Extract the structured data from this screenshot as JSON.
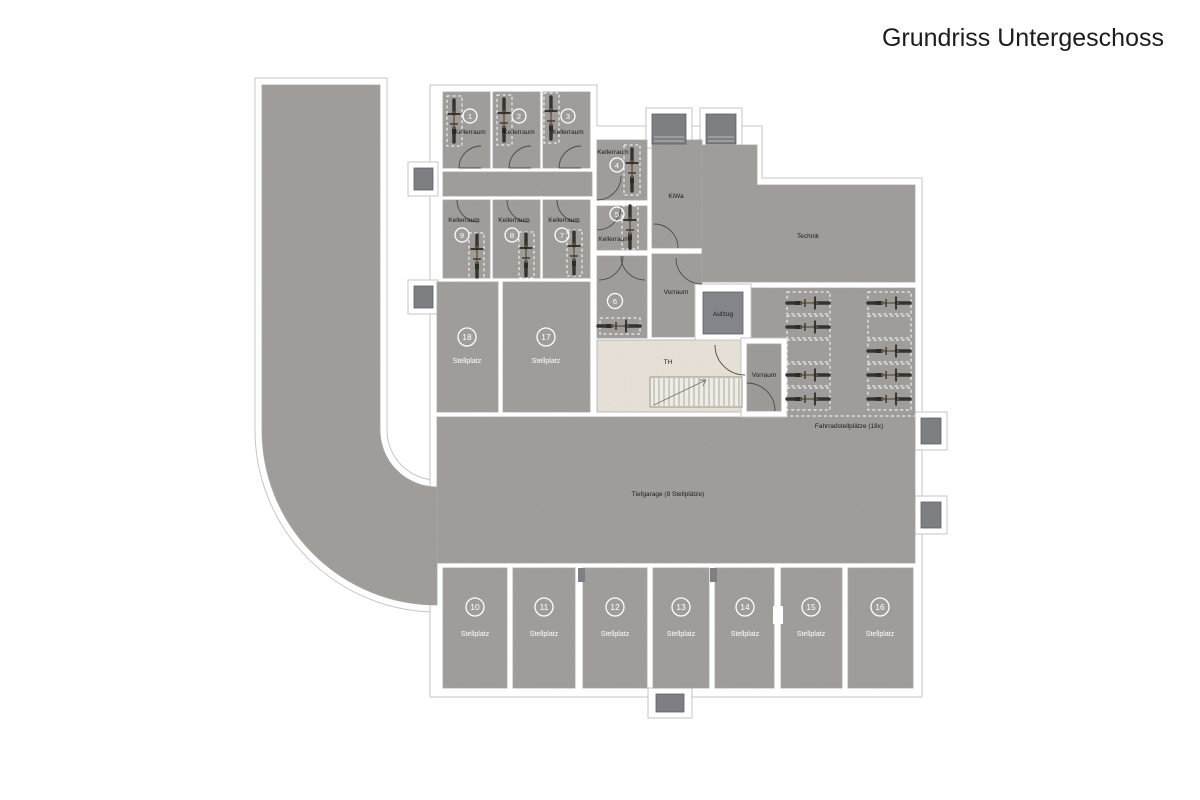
{
  "title": "Grundriss Untergeschoss",
  "floor_plan": {
    "cellar_rooms": [
      {
        "num": "1",
        "label": "Kellerraum"
      },
      {
        "num": "2",
        "label": "Kellerraum"
      },
      {
        "num": "3",
        "label": "Kellerraum"
      },
      {
        "num": "4",
        "label": "Kellerraum"
      },
      {
        "num": "5",
        "label": "Kellerraum"
      },
      {
        "num": "6",
        "label": ""
      },
      {
        "num": "7",
        "label": "Kellerraum"
      },
      {
        "num": "8",
        "label": "Kellerraum"
      },
      {
        "num": "9",
        "label": "Kellerraum"
      }
    ],
    "parking_spaces": [
      {
        "num": "10",
        "label": "Stellplatz"
      },
      {
        "num": "11",
        "label": "Stellplatz"
      },
      {
        "num": "12",
        "label": "Stellplatz"
      },
      {
        "num": "13",
        "label": "Stellplatz"
      },
      {
        "num": "14",
        "label": "Stellplatz"
      },
      {
        "num": "15",
        "label": "Stellplatz"
      },
      {
        "num": "16",
        "label": "Stellplatz"
      },
      {
        "num": "17",
        "label": "Stellplatz"
      },
      {
        "num": "18",
        "label": "Stellplatz"
      }
    ],
    "areas": {
      "stroller_room": "KiWa",
      "technical_room": "Technik",
      "anteroom_center": "Vorraum",
      "anteroom_right": "Vorraum",
      "elevator": "Aufzug",
      "stairwell": "TH",
      "garage_label": "Tiefgarage (9 Stellplätze)",
      "bike_parking_label": "Fahrradstellplätze (18x)"
    },
    "colors": {
      "floor": "#9c9a96",
      "stairwell_floor": "#eae4da",
      "elevator_cab": "#84858a",
      "light_well": "#7e7f83",
      "wall": "#ffffff"
    }
  }
}
